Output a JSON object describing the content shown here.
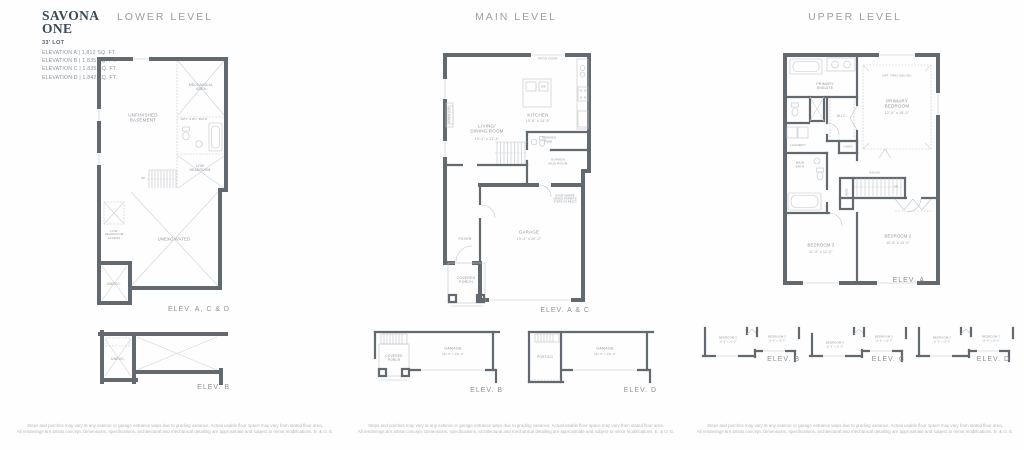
{
  "colors": {
    "brand_navy": "#394a59",
    "wall_gray": "#62696f",
    "heading_gray": "#9aa0a5",
    "label_gray": "#8f959b"
  },
  "header": {
    "title_line1": "SAVONA",
    "title_line2": "ONE",
    "lot": "33' LOT",
    "elevations": [
      "ELEVATION A | 1,812 SQ. FT.",
      "ELEVATION B | 1,835 SQ. FT.",
      "ELEVATION C | 1,835 SQ. FT.",
      "ELEVATION D | 1,842 SQ. FT."
    ]
  },
  "lower": {
    "heading": "LOWER LEVEL",
    "labels": {
      "mechanical": "MECHANICAL\nAREA",
      "basement": "UNFINISHED\nBASEMENT",
      "bath": "OPT. 3 PC. BATH",
      "low_headroom": "LOW\nHEADROOM",
      "up": "UP",
      "access": "LOW\nHEADROOM\nACCESS",
      "unexcavated": "UNEXCAVATED",
      "unexc": "UNEXC."
    },
    "elev_main": "ELEV. A, C & D",
    "elev_b": "ELEV. B"
  },
  "main": {
    "heading": "MAIN LEVEL",
    "labels": {
      "patio_door": "PATIO DOOR",
      "living": "LIVING/\nDINING ROOM",
      "living_dims": "13'-1\" x 21'-4\"",
      "kitchen": "KITCHEN",
      "kitchen_dims": "10'-6\" x 14'-5\"",
      "dw": "DW",
      "fireplace": "FIREPLACE",
      "pwd": "SUNKEN\nPWD.",
      "mud": "SUNKEN\nMUD ROOM",
      "garage": "GARAGE",
      "garage_dims": "19'-4\" x 20'-0\"",
      "foyer": "FOYER",
      "porch": "COVERED\nPORCH",
      "portico": "PORTICO",
      "door_note": "DOOR WHERE\nGRADE PERMITS\nSTEPS AS REQ'D"
    },
    "elev_main": "ELEV. A & C",
    "elev_b": "ELEV. B",
    "elev_d": "ELEV. D"
  },
  "upper": {
    "heading": "UPPER LEVEL",
    "labels": {
      "ensuite": "PRIMARY\nENSUITE",
      "tray": "OPT. TRAY CEILING",
      "primary": "PRIMARY\nBEDROOM",
      "primary_dims": "12'-0\" x 18'-0\"",
      "wic": "W.I.C.",
      "laundry": "LAUNDRY",
      "linen": "LINEN",
      "main_bath": "MAIN\nBATH",
      "railing": "RAILING",
      "dn": "DN",
      "bedroom3": "BEDROOM 3",
      "bedroom3_dims": "11'-0\" x 12'-0\"",
      "bedroom2": "BEDROOM 2",
      "bedroom2_dims": "10'-6\" x 13'-0\""
    },
    "elev_main": "ELEV. A",
    "elev_b": "ELEV. B",
    "elev_c": "ELEV. C",
    "elev_d": "ELEV. D"
  },
  "disclaimer": {
    "line1": "Steps and porches may vary at any exterior or garage entrance ways due to grading variance. Actual usable floor space may vary from stated floor area.",
    "line2": "All renderings are artists concept. Dimensions, specifications, architectural and mechanical detailing are approximate and subject to minor modifications. E. & O. E."
  }
}
